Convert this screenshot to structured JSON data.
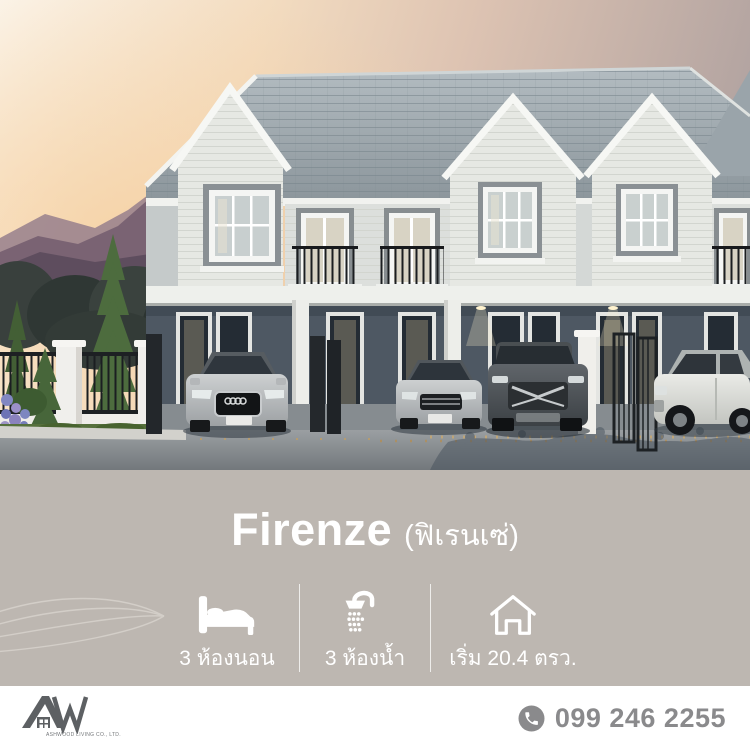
{
  "panel": {
    "title": "Firenze",
    "title_sub": "(ฟิเรนเซ่)",
    "bg_color": "#bdb7b1",
    "text_color": "#ffffff",
    "features": [
      {
        "icon": "bed-icon",
        "label": "3 ห้องนอน"
      },
      {
        "icon": "shower-icon",
        "label": "3 ห้องน้ำ"
      },
      {
        "icon": "home-icon",
        "label": "เริ่ม 20.4 ตรว."
      }
    ]
  },
  "footer": {
    "logo_monogram": "AW",
    "company": "ASHWOOD LIVING CO., LTD.",
    "phone": "099 246 2255",
    "text_color": "#8a8a8c"
  }
}
